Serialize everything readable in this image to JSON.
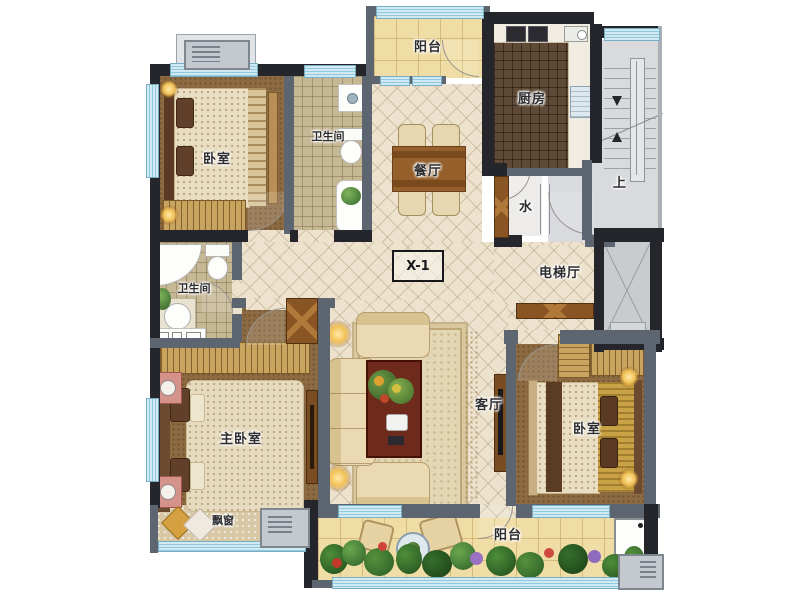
{
  "colors": {
    "wall_dark": "#24262c",
    "wall_gray": "#5d6570",
    "window_blue": "#cfeaf5",
    "floor_cream": "#ece2cd",
    "floor_balcony_yellow": "#f0dda5",
    "floor_bedroom_brown": "#8c6a42",
    "floor_bath_tile": "#c6b795",
    "floor_kitchen_dark": "#5e4a37",
    "floor_stair_gray": "#d8dadd",
    "wood_door": "#8a5524",
    "plant_green": "#3f7a33"
  },
  "rooms": {
    "balcony_top": {
      "label": "阳台"
    },
    "kitchen": {
      "label": "厨房"
    },
    "bedroom_top_left": {
      "label": "卧室"
    },
    "bathroom_top": {
      "label": "卫生间"
    },
    "dining": {
      "label": "餐厅"
    },
    "water": {
      "label": "水"
    },
    "stairs": {
      "label": "上"
    },
    "unit_code": {
      "label": "X-1"
    },
    "elevator_hall": {
      "label": "电梯厅"
    },
    "bathroom_left": {
      "label": "卫生间"
    },
    "master_bedroom": {
      "label": "主卧室"
    },
    "living": {
      "label": "客厅"
    },
    "bedroom_right": {
      "label": "卧室"
    },
    "bay_window": {
      "label": "飘窗"
    },
    "balcony_bottom": {
      "label": "阳台"
    }
  }
}
